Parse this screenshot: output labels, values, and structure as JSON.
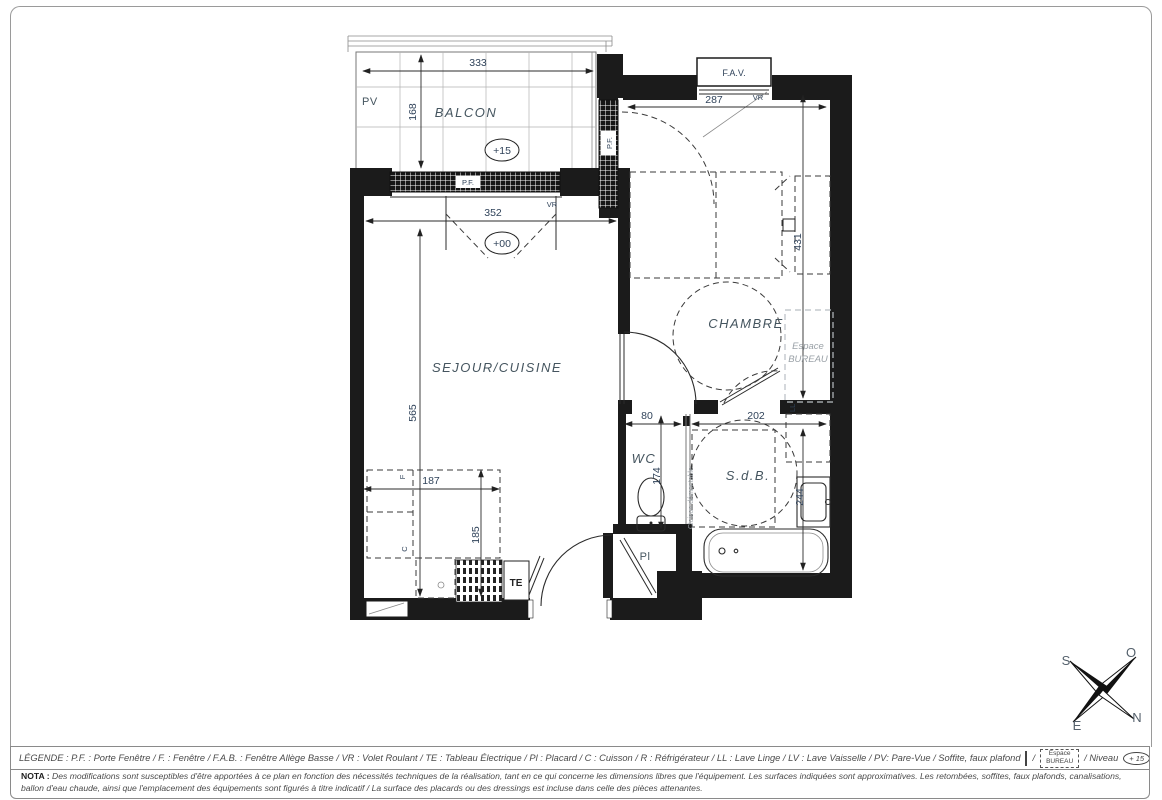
{
  "plan": {
    "rooms": {
      "balcon": "BALCON",
      "sejour": "SEJOUR/CUISINE",
      "chambre": "CHAMBRE",
      "wc": "WC",
      "sdb": "S.d.B.",
      "placard": "Pl",
      "espace_bureau_1": "Espace",
      "espace_bureau_2": "BUREAU"
    },
    "levels": {
      "balcon": "+15",
      "sejour": "+00"
    },
    "labels": {
      "pv": "PV",
      "pf_balcon": "P.F.",
      "pf_chambre": "P.F.",
      "vr_balcon": "VR",
      "vr_chambre": "VR",
      "fav": "F.A.V.",
      "te": "TE",
      "ll": "LL",
      "cloison_demontable": "Cloison démontable",
      "kitchen_f": "F",
      "kitchen_c": "C"
    },
    "dims": {
      "balcon_w": "333",
      "balcon_d": "168",
      "sejour_w": "352",
      "sejour_h": "565",
      "kitchen_w": "187",
      "kitchen_h": "185",
      "chambre_w": "287",
      "chambre_h": "431",
      "wc_w": "80",
      "wc_h": "174",
      "sdb_w": "202",
      "sdb_h": "244"
    }
  },
  "compass": {
    "south": "S",
    "ouest": "O",
    "est": "E",
    "nord": "N"
  },
  "legend": {
    "text": "LÉGENDE : P.F. : Porte Fenêtre / F. : Fenêtre / F.A.B. : Fenêtre Allège Basse / VR : Volet Roulant / TE : Tableau Électrique / Pl : Placard / C : Cuisson / R : Réfrigérateur / LL : Lave Linge / LV : Lave Vaisselle / PV: Pare-Vue / Soffite, faux plafond",
    "sep1": "/",
    "espace_1": "Espace",
    "espace_2": "BUREAU",
    "niveau": "/ Niveau",
    "niveau_value": "+ 15"
  },
  "nota": {
    "prefix": "NOTA :",
    "text": "Des modifications sont susceptibles d'être apportées à ce plan en fonction des nécessités techniques de la réalisation, tant en ce qui concerne les dimensions libres que l'équipement. Les surfaces indiquées sont approximatives. Les retombées, soffites, faux plafonds, canalisations, ballon d'eau chaude, ainsi que l'emplacement des équipements sont figurés à titre indicatif / La surface des placards ou des dressings est incluse dans celle des pièces attenantes."
  },
  "colors": {
    "wall": "#1b1b1b",
    "dim_text": "#30435a",
    "room_text": "#45555f",
    "muted_text": "#9aa1a7"
  }
}
